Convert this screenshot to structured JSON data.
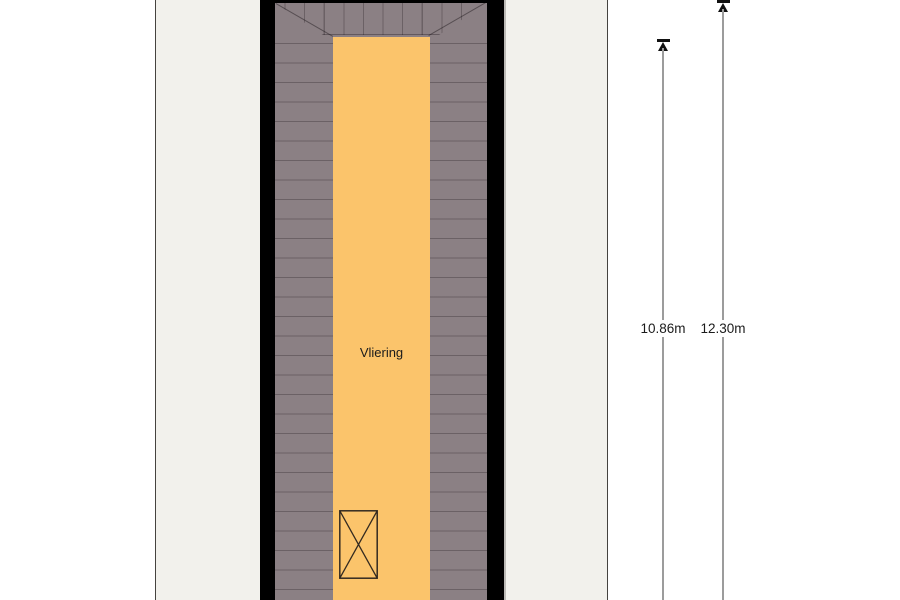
{
  "plan": {
    "room_label": "Vliering"
  },
  "dimensions": {
    "inner": {
      "label": "10.86m"
    },
    "outer": {
      "label": "12.30m"
    }
  },
  "colors": {
    "sheet_background": "#f2f1ec",
    "wall": "#000000",
    "roof_floor": "#8b8084",
    "loft_floor": "#fbc46b",
    "dimension_line": "#9c9c9c",
    "text": "#1b1b1b"
  }
}
